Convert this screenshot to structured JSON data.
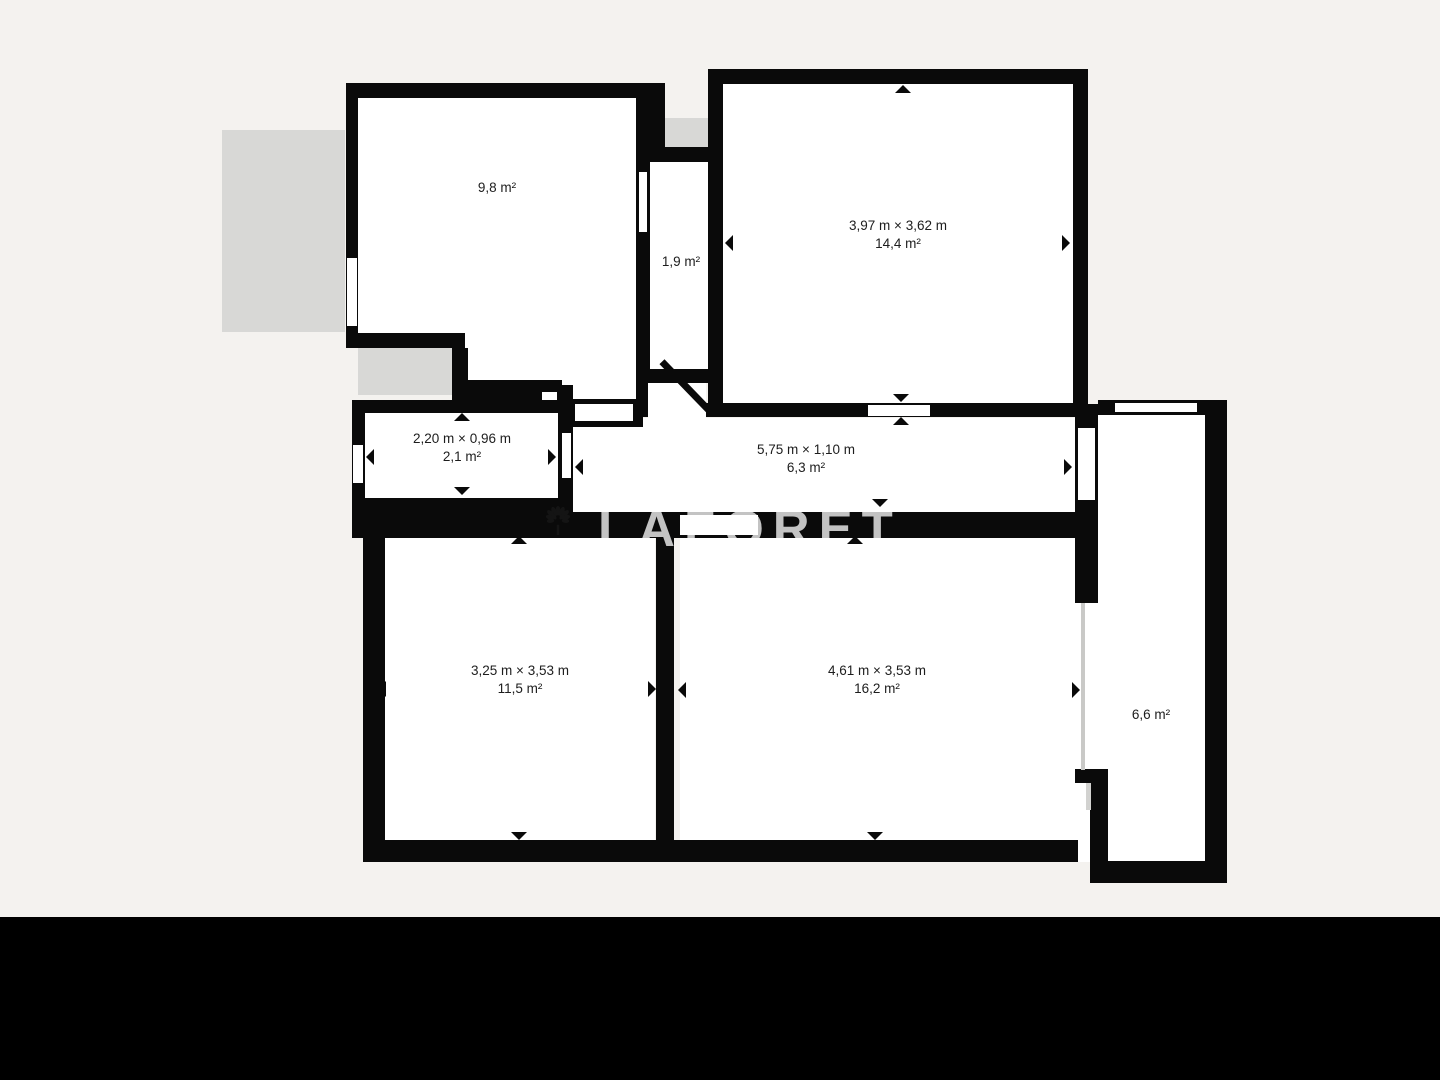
{
  "floorplan": {
    "background_color": "#f4f2ef",
    "wall_color": "#0a0a0a",
    "floor_color": "#ffffff",
    "terrace_color": "#d8d8d6",
    "rooms": {
      "top_left": {
        "area": "9,8 m²"
      },
      "closet": {
        "area": "1,9 m²"
      },
      "top_right": {
        "dimensions": "3,97 m × 3,62 m",
        "area": "14,4 m²"
      },
      "small_left": {
        "dimensions": "2,20 m × 0,96 m",
        "area": "2,1 m²"
      },
      "hallway": {
        "dimensions": "5,75 m × 1,10 m",
        "area": "6,3 m²"
      },
      "bottom_left": {
        "dimensions": "3,25 m × 3,53 m",
        "area": "11,5 m²"
      },
      "bottom_right": {
        "dimensions": "4,61 m × 3,53 m",
        "area": "16,2 m²"
      },
      "right_annex": {
        "area": "6,6 m²"
      }
    },
    "watermark": {
      "brand": "LAFORÊT",
      "icon": "tree-icon",
      "color": "#c3c3c3"
    }
  }
}
